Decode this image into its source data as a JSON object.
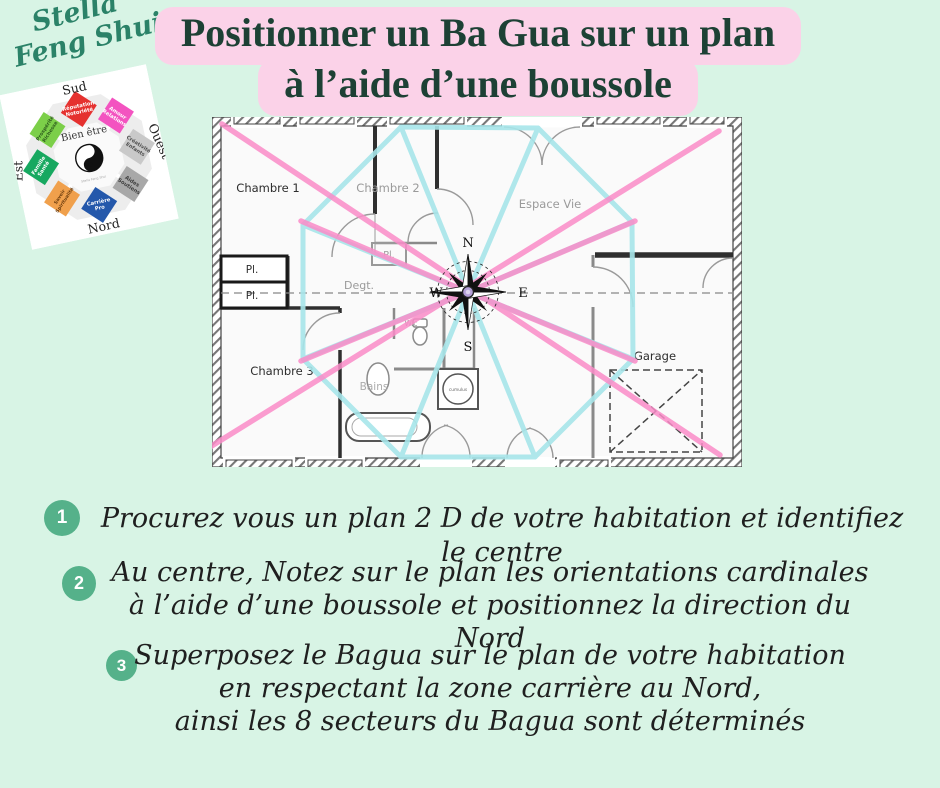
{
  "canvas": {
    "bg": "#d8f4e5"
  },
  "brand": {
    "line1": "Stella",
    "line2": "Feng Shui",
    "color": "#2b8268"
  },
  "logo": {
    "directions": {
      "top": "Sud",
      "right": "Ouest",
      "bottom": "Nord",
      "left": "Est"
    },
    "center": {
      "title": "Bien être",
      "subtitle": "Stella Feng Shui"
    },
    "sectors": [
      {
        "position": "top",
        "line1": "Réputation",
        "line2": "Notoriété",
        "color": "#e5312f",
        "text_color": "#ffffff"
      },
      {
        "position": "top-right",
        "line1": "Amour",
        "line2": "Relations",
        "color": "#f353c0",
        "text_color": "#ffffff"
      },
      {
        "position": "right",
        "line1": "Créativité",
        "line2": "Enfants",
        "color": "#c9c9c9",
        "text_color": "#4f4f4f"
      },
      {
        "position": "bottom-right",
        "line1": "Aides",
        "line2": "Soutiens",
        "color": "#a8a8a8",
        "text_color": "#3d3d3d"
      },
      {
        "position": "bottom",
        "line1": "Carrière",
        "line2": "Pro",
        "color": "#2458ab",
        "text_color": "#ffffff"
      },
      {
        "position": "bottom-left",
        "line1": "Savoir",
        "line2": "Spiritualité",
        "color": "#f0a04c",
        "text_color": "#6b3c0e"
      },
      {
        "position": "left",
        "line1": "Famille",
        "line2": "Santé",
        "color": "#17a860",
        "text_color": "#ffffff"
      },
      {
        "position": "top-left",
        "line1": "Prospérité",
        "line2": "Richesse",
        "color": "#7ccf49",
        "text_color": "#2e5c1e"
      }
    ]
  },
  "title": {
    "line1": "Positionner un Ba Gua sur un plan",
    "line2": "à l’aide d’une boussole",
    "bg": "#fbd2e8",
    "color": "#1d4135"
  },
  "plan": {
    "rooms": {
      "chambre1": "Chambre 1",
      "chambre2": "Chambre 2",
      "espace_vie": "Espace Vie",
      "chambre3": "Chambre 3",
      "garage": "Garage",
      "degagement": "Degt.",
      "pl_left_top": "Pl.",
      "pl_left_bottom": "Pl.",
      "pl_chambre2": "Pl.",
      "wc": "W.c",
      "bains": "Bains",
      "cumulus": "cumulus"
    },
    "compass": {
      "north": "N",
      "south": "S",
      "east": "E",
      "west": "W"
    },
    "overlay": {
      "bagua_outline_color": "#a7e6ea",
      "diagonal_color": "#fa8cc8"
    }
  },
  "steps": [
    {
      "number": "1",
      "lines": [
        "Procurez vous un plan 2 D de votre habitation et identifiez le centre"
      ]
    },
    {
      "number": "2",
      "lines": [
        "Au centre,  Notez sur le plan les orientations cardinales",
        "à l’aide d’une boussole et positionnez la direction du Nord"
      ]
    },
    {
      "number": "3",
      "lines": [
        "Superposez le  Bagua sur le plan de votre habitation",
        "en respectant  la zone carrière au Nord,",
        "ainsi les 8 secteurs du  Bagua sont déterminés"
      ]
    }
  ],
  "step_badge_color": "#55b18a"
}
